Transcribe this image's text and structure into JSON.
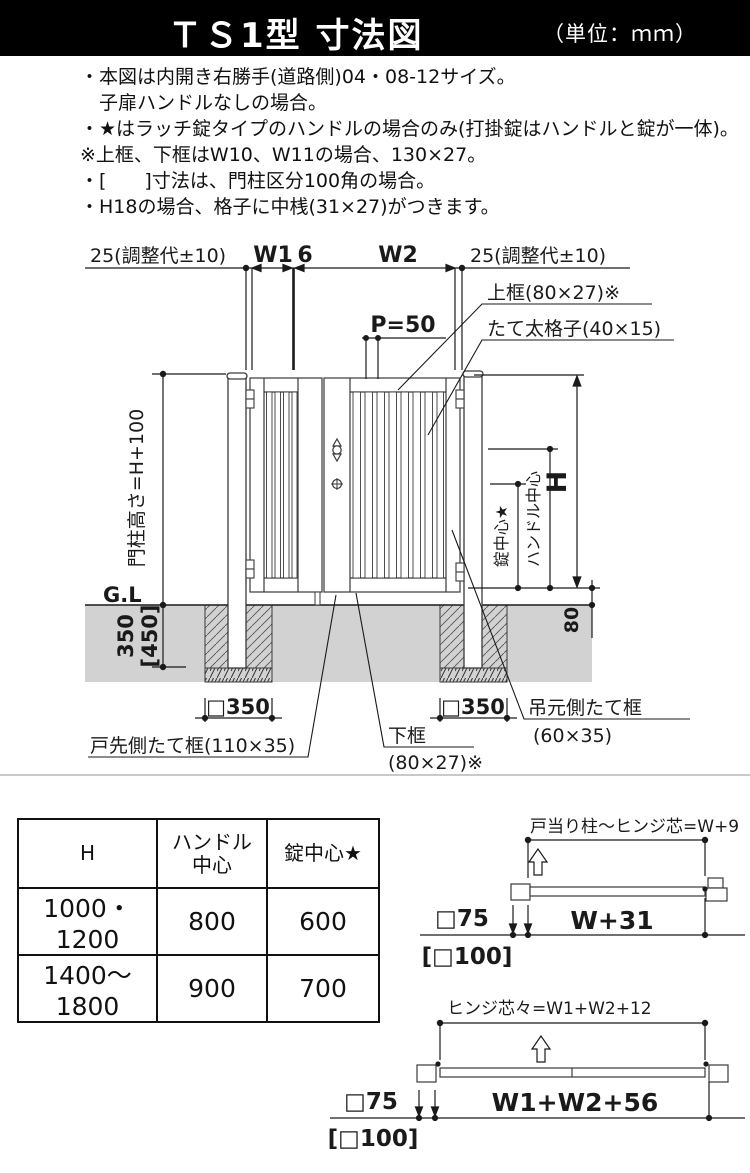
{
  "header": {
    "title": "ＴＳ1型 寸法図",
    "unit": "（単位：ｍｍ）"
  },
  "notes": {
    "lines": [
      "・本図は内開き右勝手(道路側)04・08-12サイズ。",
      "　子扉ハンドルなしの場合。",
      "・★はラッチ錠タイプのハンドルの場合のみ(打掛錠はハンドルと錠が一体)。",
      "※上框、下框はW10、W11の場合、130×27。",
      "・[　　]寸法は、門柱区分100角の場合。",
      "・H18の場合、格子に中桟(31×27)がつきます。"
    ]
  },
  "diagram": {
    "dims": {
      "adjust_left": "25(調整代±10)",
      "w1": "W1",
      "gap": "6",
      "w2": "W2",
      "adjust_right": "25(調整代±10)",
      "pitch": "P=50",
      "post_height": "門柱高さ=H+100",
      "gl": "G.L",
      "embed": "350",
      "embed_alt": "[450]",
      "height": "H",
      "handle_center": "ハンドル中心",
      "lock_center": "錠中心★",
      "ground_clearance": "80",
      "footing_left": "□350",
      "footing_right": "□350"
    },
    "labels": {
      "top_rail": "上框(80×27)※",
      "grille": "たて太格子(40×15)",
      "latch_stile": "戸先側たて框(110×35)",
      "bottom_rail_1": "下框",
      "bottom_rail_2": "(80×27)※",
      "hinge_stile_1": "吊元側たて框",
      "hinge_stile_2": "(60×35)"
    }
  },
  "spec_table": {
    "col_h": "H",
    "col_handle_1": "ハンドル",
    "col_handle_2": "中心",
    "col_lock": "錠中心★",
    "rows": [
      [
        "1000・1200",
        "800",
        "600"
      ],
      [
        "1400～1800",
        "900",
        "700"
      ]
    ]
  },
  "plans": {
    "a": {
      "formula": "戸当り柱～ヒンジ芯=W+9",
      "post": "□75",
      "post_alt": "[□100]",
      "width": "W+31"
    },
    "b": {
      "formula": "ヒンジ芯々=W1+W2+12",
      "post": "□75",
      "post_alt": "[□100]",
      "width": "W1+W2+56"
    }
  }
}
